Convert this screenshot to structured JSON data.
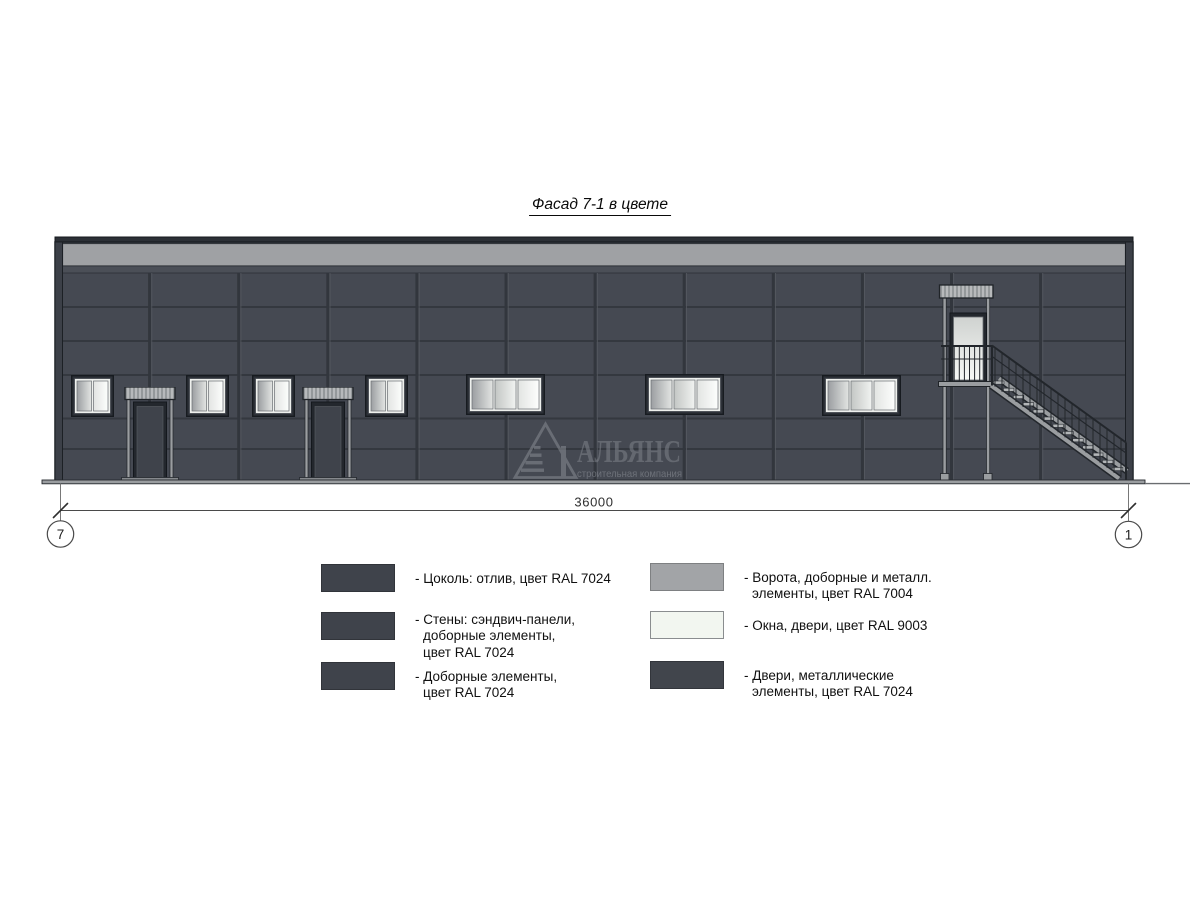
{
  "title": "Фасад 7-1 в цвете",
  "dimension": {
    "value": "36000",
    "axis_left": "7",
    "axis_right": "1"
  },
  "watermark": {
    "name": "АЛЬЯНС",
    "subtitle": "строительная компания"
  },
  "colors": {
    "wall": "#454952",
    "joint": "#32363d",
    "parapet": "#9fa1a4",
    "trim": "#3c4048",
    "roof": "#2c3036",
    "canopy": "#b7b9bb",
    "metal": "#9a9da0",
    "door_dark": "#3f434b",
    "window_frame": "#2d3138",
    "sash": "#eef0ed",
    "ground": "#9a9da0",
    "outline": "#1c2025"
  },
  "legend": {
    "left": [
      {
        "swatch": "#3f434b",
        "lines": [
          "- Цоколь: отлив, цвет RAL 7024"
        ]
      },
      {
        "swatch": "#3f434b",
        "lines": [
          "- Стены: сэндвич-панели,",
          "доборные элементы,",
          "цвет RAL 7024"
        ]
      },
      {
        "swatch": "#3f434b",
        "lines": [
          "- Доборные элементы,",
          "цвет RAL 7024"
        ]
      }
    ],
    "right": [
      {
        "swatch": "#a2a4a7",
        "lines": [
          "- Ворота, доборные и металл.",
          "элементы, цвет RAL 7004"
        ]
      },
      {
        "swatch": "#f2f6f0",
        "border": "#8a8d8f",
        "lines": [
          "- Окна, двери, цвет RAL 9003"
        ]
      },
      {
        "swatch": "#41454c",
        "lines": [
          "- Двери, металлические",
          "элементы, цвет RAL 7024"
        ]
      }
    ]
  }
}
